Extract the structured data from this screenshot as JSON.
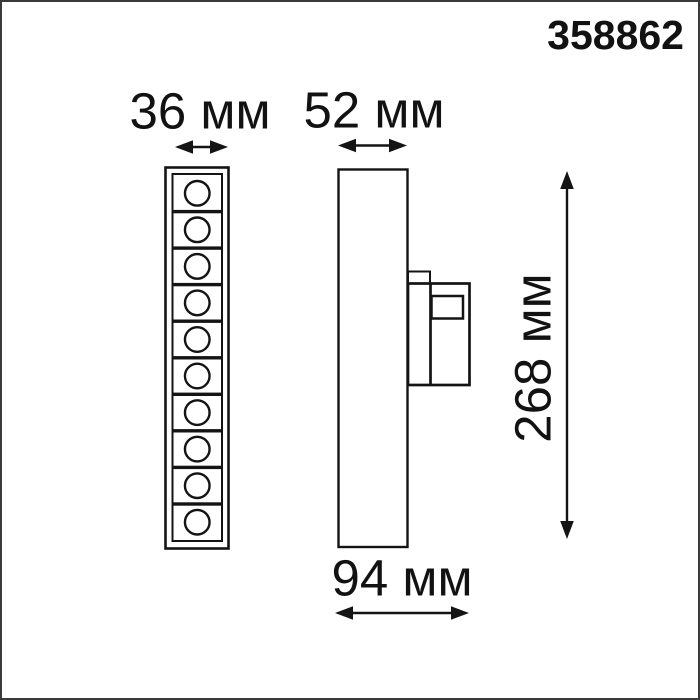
{
  "product_number": "358862",
  "unit": "мм",
  "dimensions": {
    "front_width": {
      "value": 36,
      "unit": "мм",
      "label": "36 мм"
    },
    "side_width": {
      "value": 52,
      "unit": "мм",
      "label": "52 мм"
    },
    "height": {
      "value": 268,
      "unit": "мм",
      "label": "268 мм"
    },
    "depth": {
      "value": 94,
      "unit": "мм",
      "label": "94 мм"
    }
  },
  "views": {
    "front": {
      "description": "front view of linear light with LED cells",
      "led_cells": 10
    },
    "side": {
      "description": "side view of light body with track adapter"
    }
  },
  "colors": {
    "background": "#ffffff",
    "line": "#141414",
    "text": "#121212",
    "frame_border": "#3a3a3a"
  }
}
